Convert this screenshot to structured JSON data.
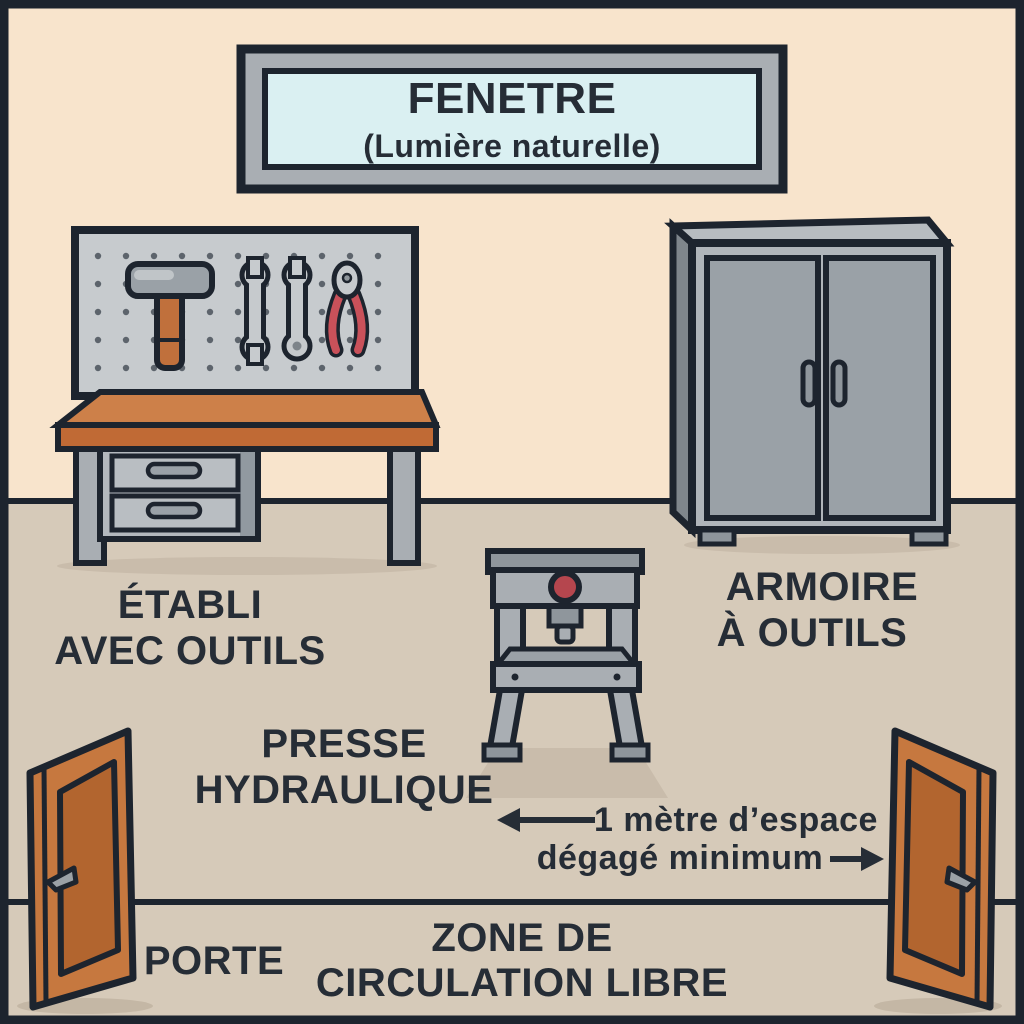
{
  "scene": {
    "window_sign": {
      "title": "FENETRE",
      "subtitle": "(Lumière naturelle)"
    },
    "workbench_label": {
      "line1": "ÉTABLI",
      "line2": "AVEC OUTILS"
    },
    "cabinet_label": {
      "line1": "ARMOIRE",
      "line2": "À OUTILS"
    },
    "press_label": {
      "line1": "PRESSE",
      "line2": "HYDRAULIQUE"
    },
    "clearance_note": {
      "line1": "1 mètre d’espace",
      "line2": "dégagé minimum"
    },
    "door_label": "PORTE",
    "zone_label": {
      "line1": "ZONE DE",
      "line2": "CIRCULATION LIBRE"
    }
  },
  "icons": [
    "window-sign",
    "pegboard",
    "hammer-icon",
    "wrench-icon",
    "combination-wrench-icon",
    "pliers-icon",
    "workbench",
    "tool-cabinet",
    "hydraulic-press",
    "door-left-icon",
    "door-right-icon",
    "left-arrow-icon",
    "right-arrow-icon"
  ],
  "palette": {
    "wall": "#f8e4cc",
    "floor": "#d6cab9",
    "shadow": "#c7baa8",
    "outline": "#1d242e",
    "window_glass": "#daf0f2",
    "frame_gray": "#a9aeb3",
    "metal_light": "#c6cacd",
    "metal_mid": "#9aa1a7",
    "metal_dark": "#7f868c",
    "wood_orange": "#c6783f",
    "wood_dark": "#b2652f",
    "accent_red": "#c9515a",
    "gauge_red": "#b5464e",
    "text": "#262d36"
  }
}
